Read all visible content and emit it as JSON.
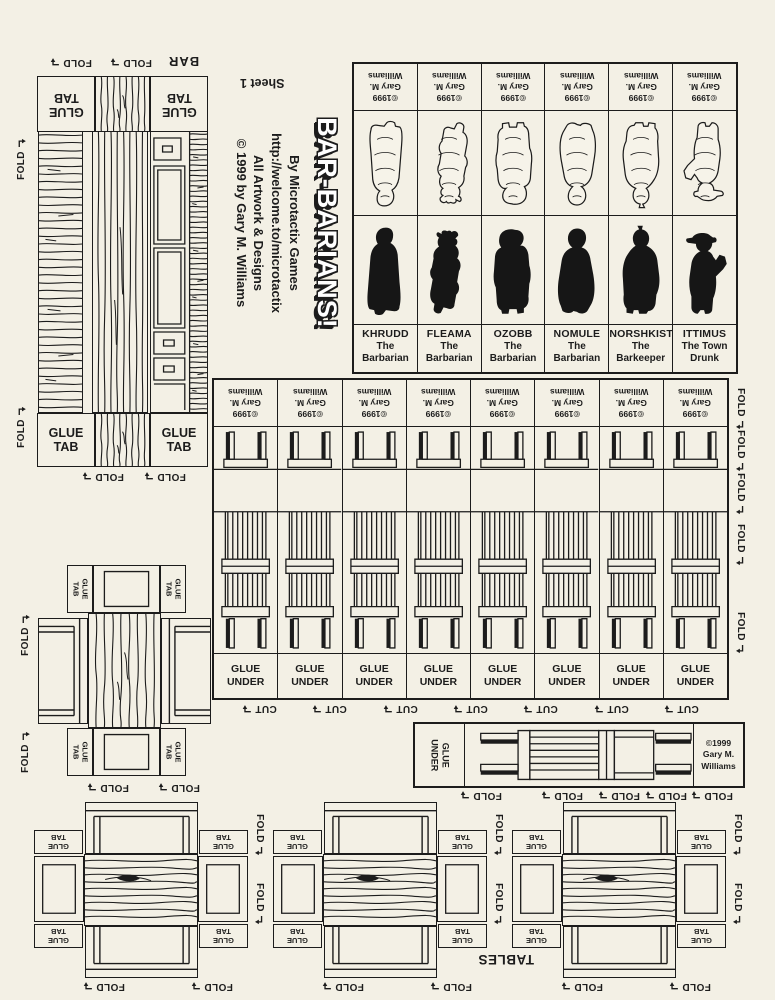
{
  "sheet": {
    "label": "Sheet 1"
  },
  "title_block": {
    "title": "BAR-BARIANS!",
    "byline": "By Microtactix Games",
    "url": "http://welcome.to/microtactix",
    "artwork_line": "All Artwork & Designs",
    "copyright_line": "© 1999 by Gary M. Williams"
  },
  "labels": {
    "fold": "FOLD",
    "cut": "CUT",
    "bar": "BAR",
    "tables": "TABLES",
    "glue": "GLUE",
    "tab": "TAB",
    "under": "UNDER"
  },
  "copyright": {
    "line1": "©1999",
    "line2": "Gary M.",
    "line3": "Williams"
  },
  "characters": [
    {
      "name": "KHRUDD",
      "title_line1": "The",
      "title_line2": "Barbarian"
    },
    {
      "name": "FLEAMA",
      "title_line1": "The",
      "title_line2": "Barbarian"
    },
    {
      "name": "OZOBB",
      "title_line1": "The",
      "title_line2": "Barbarian"
    },
    {
      "name": "NOMULE",
      "title_line1": "The",
      "title_line2": "Barbarian"
    },
    {
      "name": "NORSHKIST",
      "title_line1": "The",
      "title_line2": "Barkeeper"
    },
    {
      "name": "ITTIMUS",
      "title_line1": "The Town",
      "title_line2": "Drunk"
    }
  ],
  "icons": {
    "fold_arrow": "corner-down-arrow"
  },
  "colors": {
    "paper": "#f3f0e5",
    "ink": "#1c1c1c"
  }
}
